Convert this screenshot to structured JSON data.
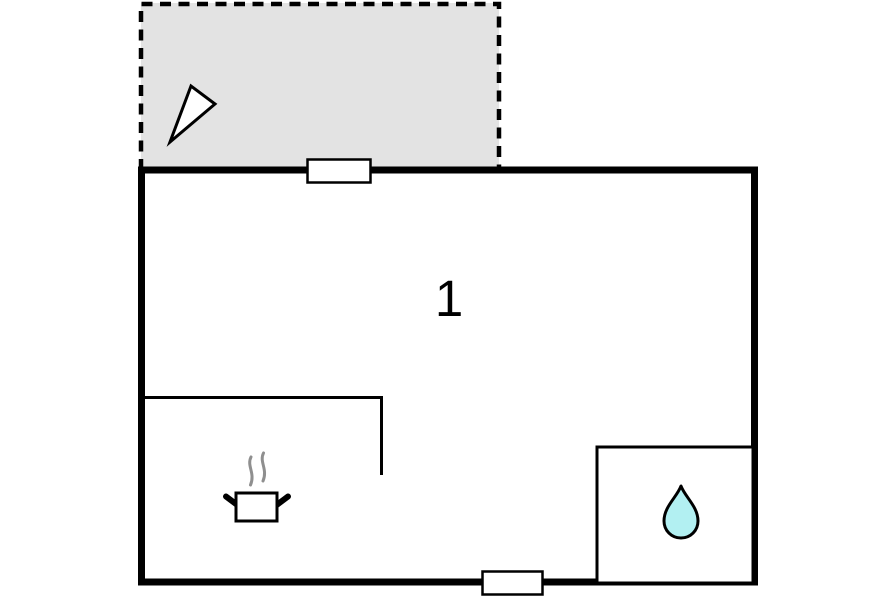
{
  "floorplan": {
    "rooms": {
      "main_room": {
        "label": "1"
      },
      "terrace": {
        "label": ""
      },
      "bathroom": {
        "label": ""
      }
    },
    "icons": {
      "north_arrow": "north-arrow-icon",
      "cooking_pot": "cooking-pot-icon",
      "steam": "steam-icon",
      "water_drop": "water-drop-icon"
    },
    "colors": {
      "wall": "#000000",
      "background": "#ffffff",
      "terrace_fill": "#e3e3e3",
      "opening_fill": "#ffffff",
      "arrow_fill": "#ffffff",
      "steam": "#8f8f8f",
      "drop_fill": "#b2f0f2",
      "label": "#000000"
    }
  }
}
